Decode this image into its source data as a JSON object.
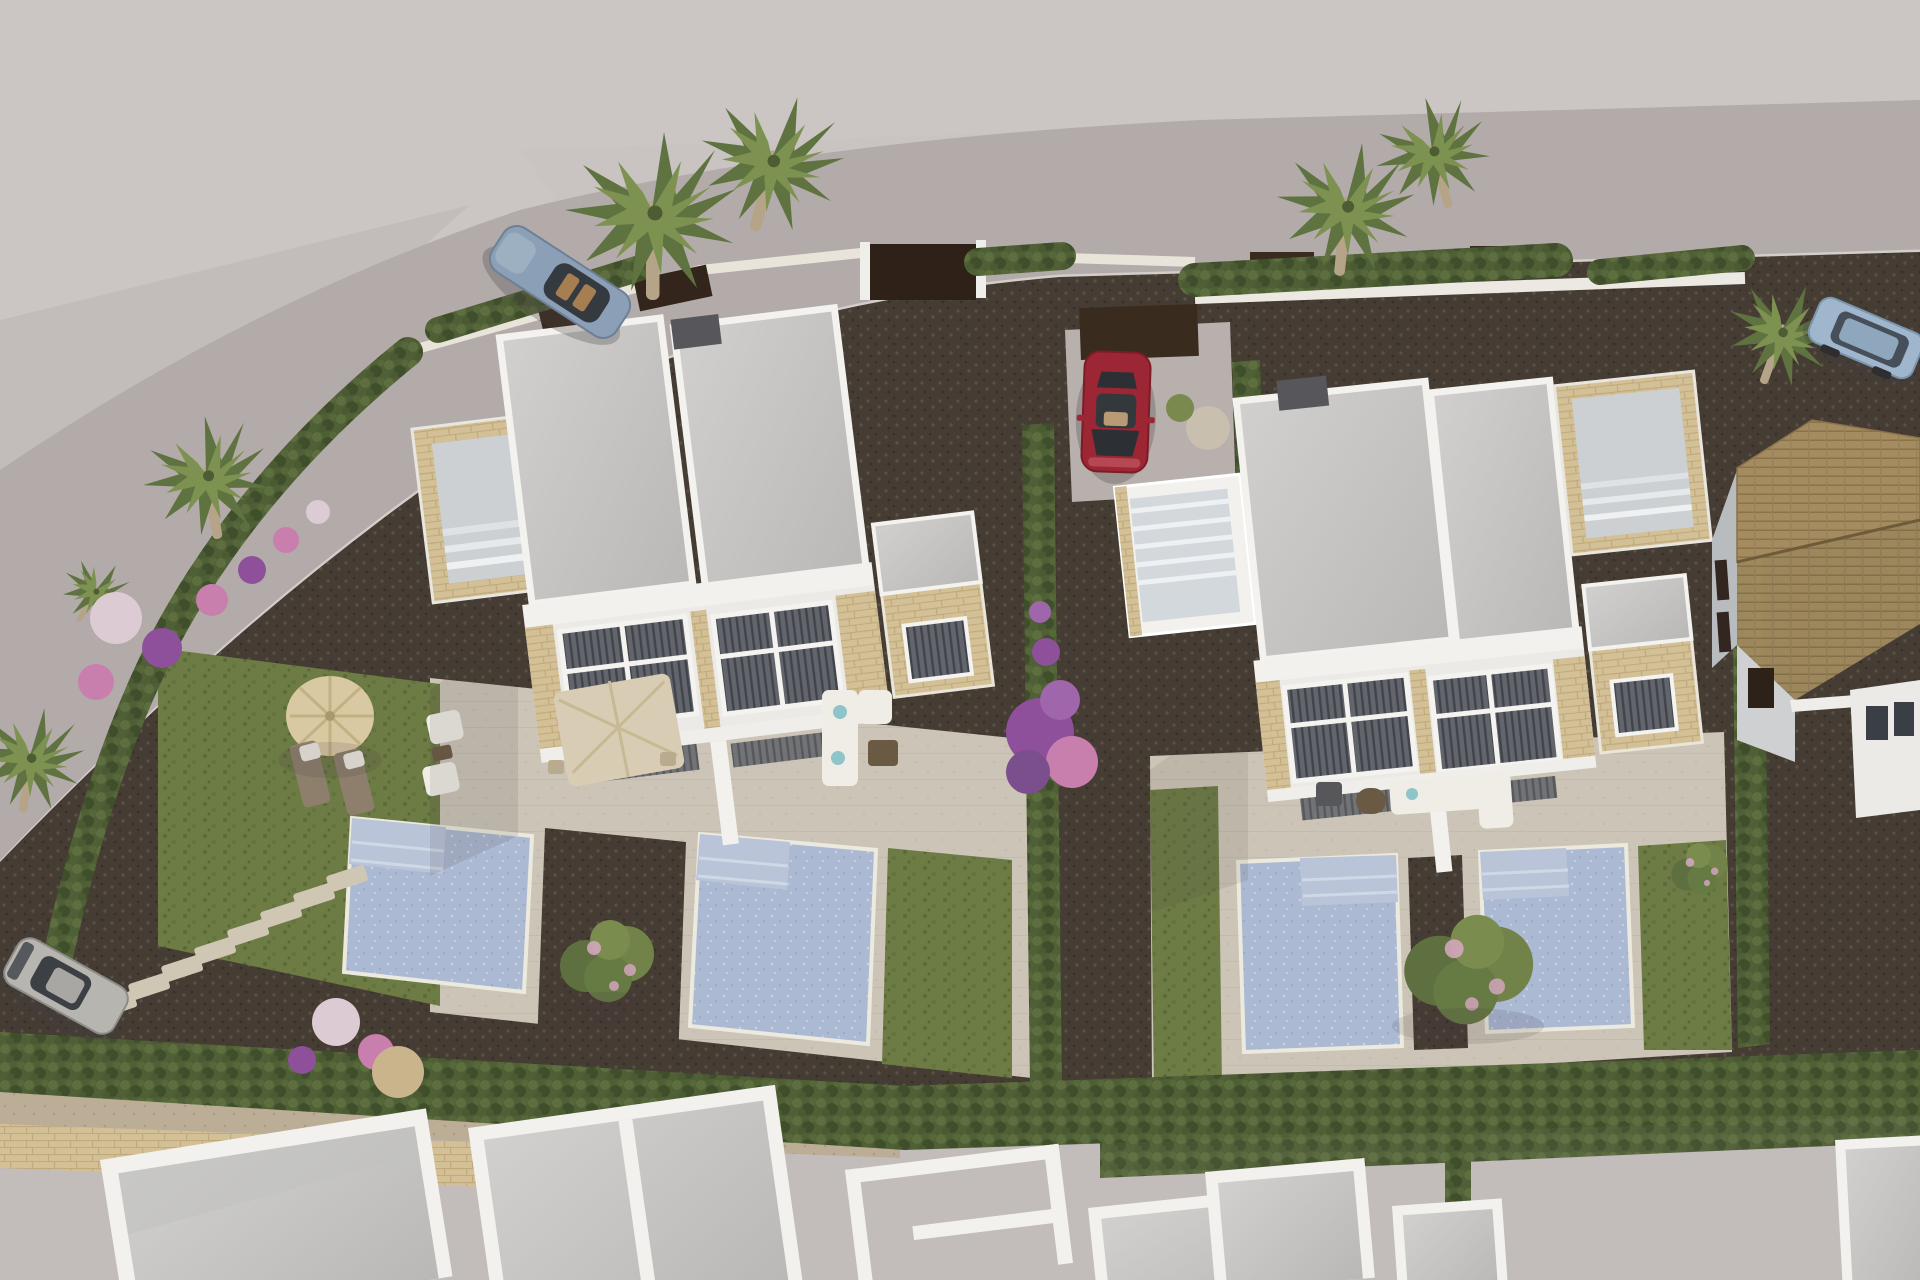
{
  "meta": {
    "type": "3d-architectural-rendering",
    "view": "aerial-oblique",
    "subject": "Residential development of modern white duplex villas with private pools, lawns, hedged gardens, palm trees and parked cars beside a curving access road",
    "time_of_day": "daytime"
  },
  "palette": {
    "terrain": "#c2bcbb",
    "terrainLight": "#cbc6c4",
    "road": "#b2abaa",
    "curb": "#d8d4d0",
    "shadow": "rgba(70,60,66,0.28)",
    "white": "#f2f1ee",
    "wallShade": "#d8d6d1",
    "roofLight": "#d1d0ce",
    "roofDark": "#b9b8b6",
    "stone": "#d3c096",
    "stoneDark": "#c0aa7c",
    "glass": "#62656b",
    "glassDark": "#41454b",
    "pool": "#abb9d3",
    "poolLight": "#c4cfe0",
    "poolStep": "#b9c4d8",
    "lawn": "#6d7b45",
    "lawnDark": "#5a6a37",
    "hedge": "#4f5f36",
    "hedgeDark": "#3f4e2b",
    "hedgeLight": "#5d6e3f",
    "gravel": "#453c33",
    "gravelDot": "#5a5045",
    "gravelLight": "#b7b0ac",
    "terrace": "#ccc5b7",
    "terraceDot": "#bfb8aa",
    "walk": "#bcae96",
    "fence": "#3a2b1f",
    "garageDoor": "#2f2118",
    "tile": "#a48c60",
    "tileDark": "#8a7249",
    "blossom": "#d9a8c4",
    "purple": "#8e4f9b",
    "pink": "#c97fae",
    "flowerWhite": "#ddcbd4",
    "trunk": "#b5a488",
    "palm": "#5f7340",
    "palmLight": "#7d9150",
    "carSports": "#8ba0b6",
    "carRed": "#9c2633",
    "carSuv": "#9fb6cd",
    "carSilver": "#b7b5b0",
    "boulder": "#c9b48c",
    "stepStone": "#cfc6b4",
    "floor": "#ccd0d3",
    "acUnit": "#57565a",
    "umbrella": "#d9c9a3",
    "parasol": "#d8cdb4",
    "sofa": "#f0ede6",
    "wicker": "#6b5a43",
    "lounger": "#8d7f6c"
  },
  "scene": {
    "villas": [
      {
        "name": "left-duplex-villa",
        "features": [
          "flat gravel roof",
          "west roof terrace with stone parapet",
          "large glazed facade",
          "beige stone trim",
          "covered terrace with square parasol and dining set",
          "outdoor sofa",
          "two private pools"
        ]
      },
      {
        "name": "right-duplex-villa",
        "features": [
          "flat gravel roof",
          "west staircase to roof",
          "east roof terrace with stone parapet",
          "large glazed facade",
          "outdoor lounge furniture",
          "two private pools",
          "driveway with parked car"
        ]
      }
    ],
    "pools": 4,
    "vehicles": [
      {
        "name": "sports-car",
        "color_key": "carSports",
        "location": "access road top left"
      },
      {
        "name": "red-sedan",
        "color_key": "carRed",
        "location": "driveway between villas"
      },
      {
        "name": "suv",
        "color_key": "carSuv",
        "location": "access road top right"
      },
      {
        "name": "crossover",
        "color_key": "carSilver",
        "location": "driveway bottom left"
      }
    ],
    "vegetation": {
      "palm_trees": 8,
      "blossom_trees": 3,
      "bougainvillea_bush": 1,
      "flower_ball_shrubs": [
        "pink",
        "purple",
        "white"
      ],
      "hedges": "cypress hedge rows along boundaries and between gardens"
    },
    "neighbors": [
      "tan tiled-roof house on the right",
      "row of unfinished white flat-roof buildings along the bottom",
      "stone boundary wall bottom left"
    ],
    "hardscape": [
      "curving access road",
      "dark gravel paths",
      "beige stone terraces",
      "diagonal stepping-stone path",
      "dark timber fence panels and garage door"
    ]
  }
}
